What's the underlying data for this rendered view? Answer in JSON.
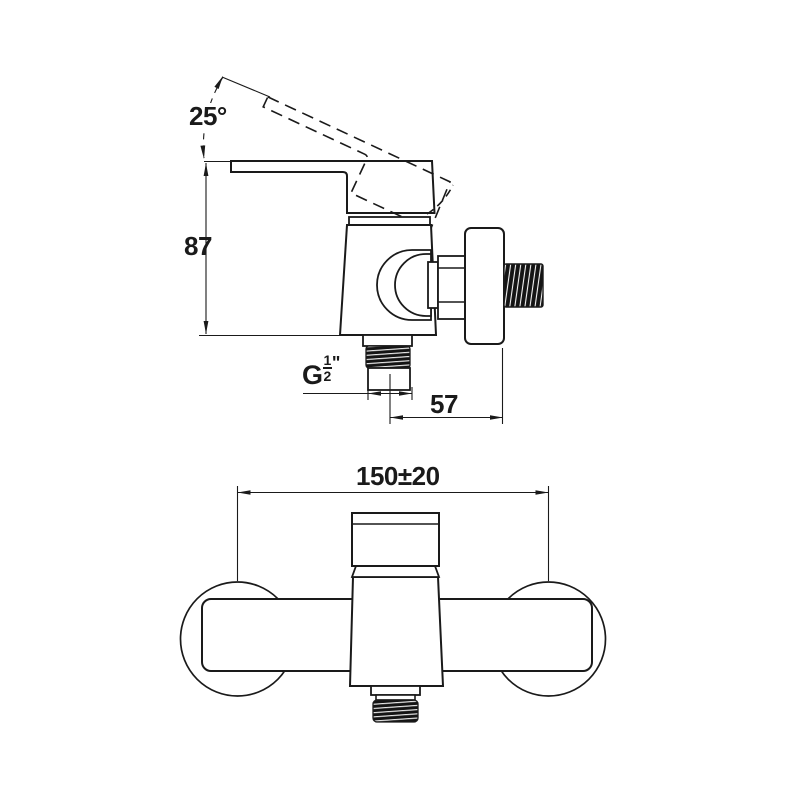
{
  "drawing": {
    "description": "Technical dimension drawing of a wall-mounted single-lever shower mixer, side view and front view",
    "views": {
      "side_view": "faucet side profile with lever shown horizontal and raised (dashed) position",
      "front_view": "faucet front elevation with two wall-mount escutcheons"
    },
    "labels": {
      "handle_angle": "25°",
      "body_height": "87",
      "bottom_offset": "57",
      "mount_centers": "150±20",
      "thread": {
        "prefix": "G",
        "numerator": "1",
        "denominator": "2",
        "suffix": "\""
      }
    },
    "colors": {
      "line": "#1a1a1a",
      "background": "#ffffff",
      "thread_fill": "#141414",
      "thread_hatch": "#f5f5f5"
    }
  }
}
